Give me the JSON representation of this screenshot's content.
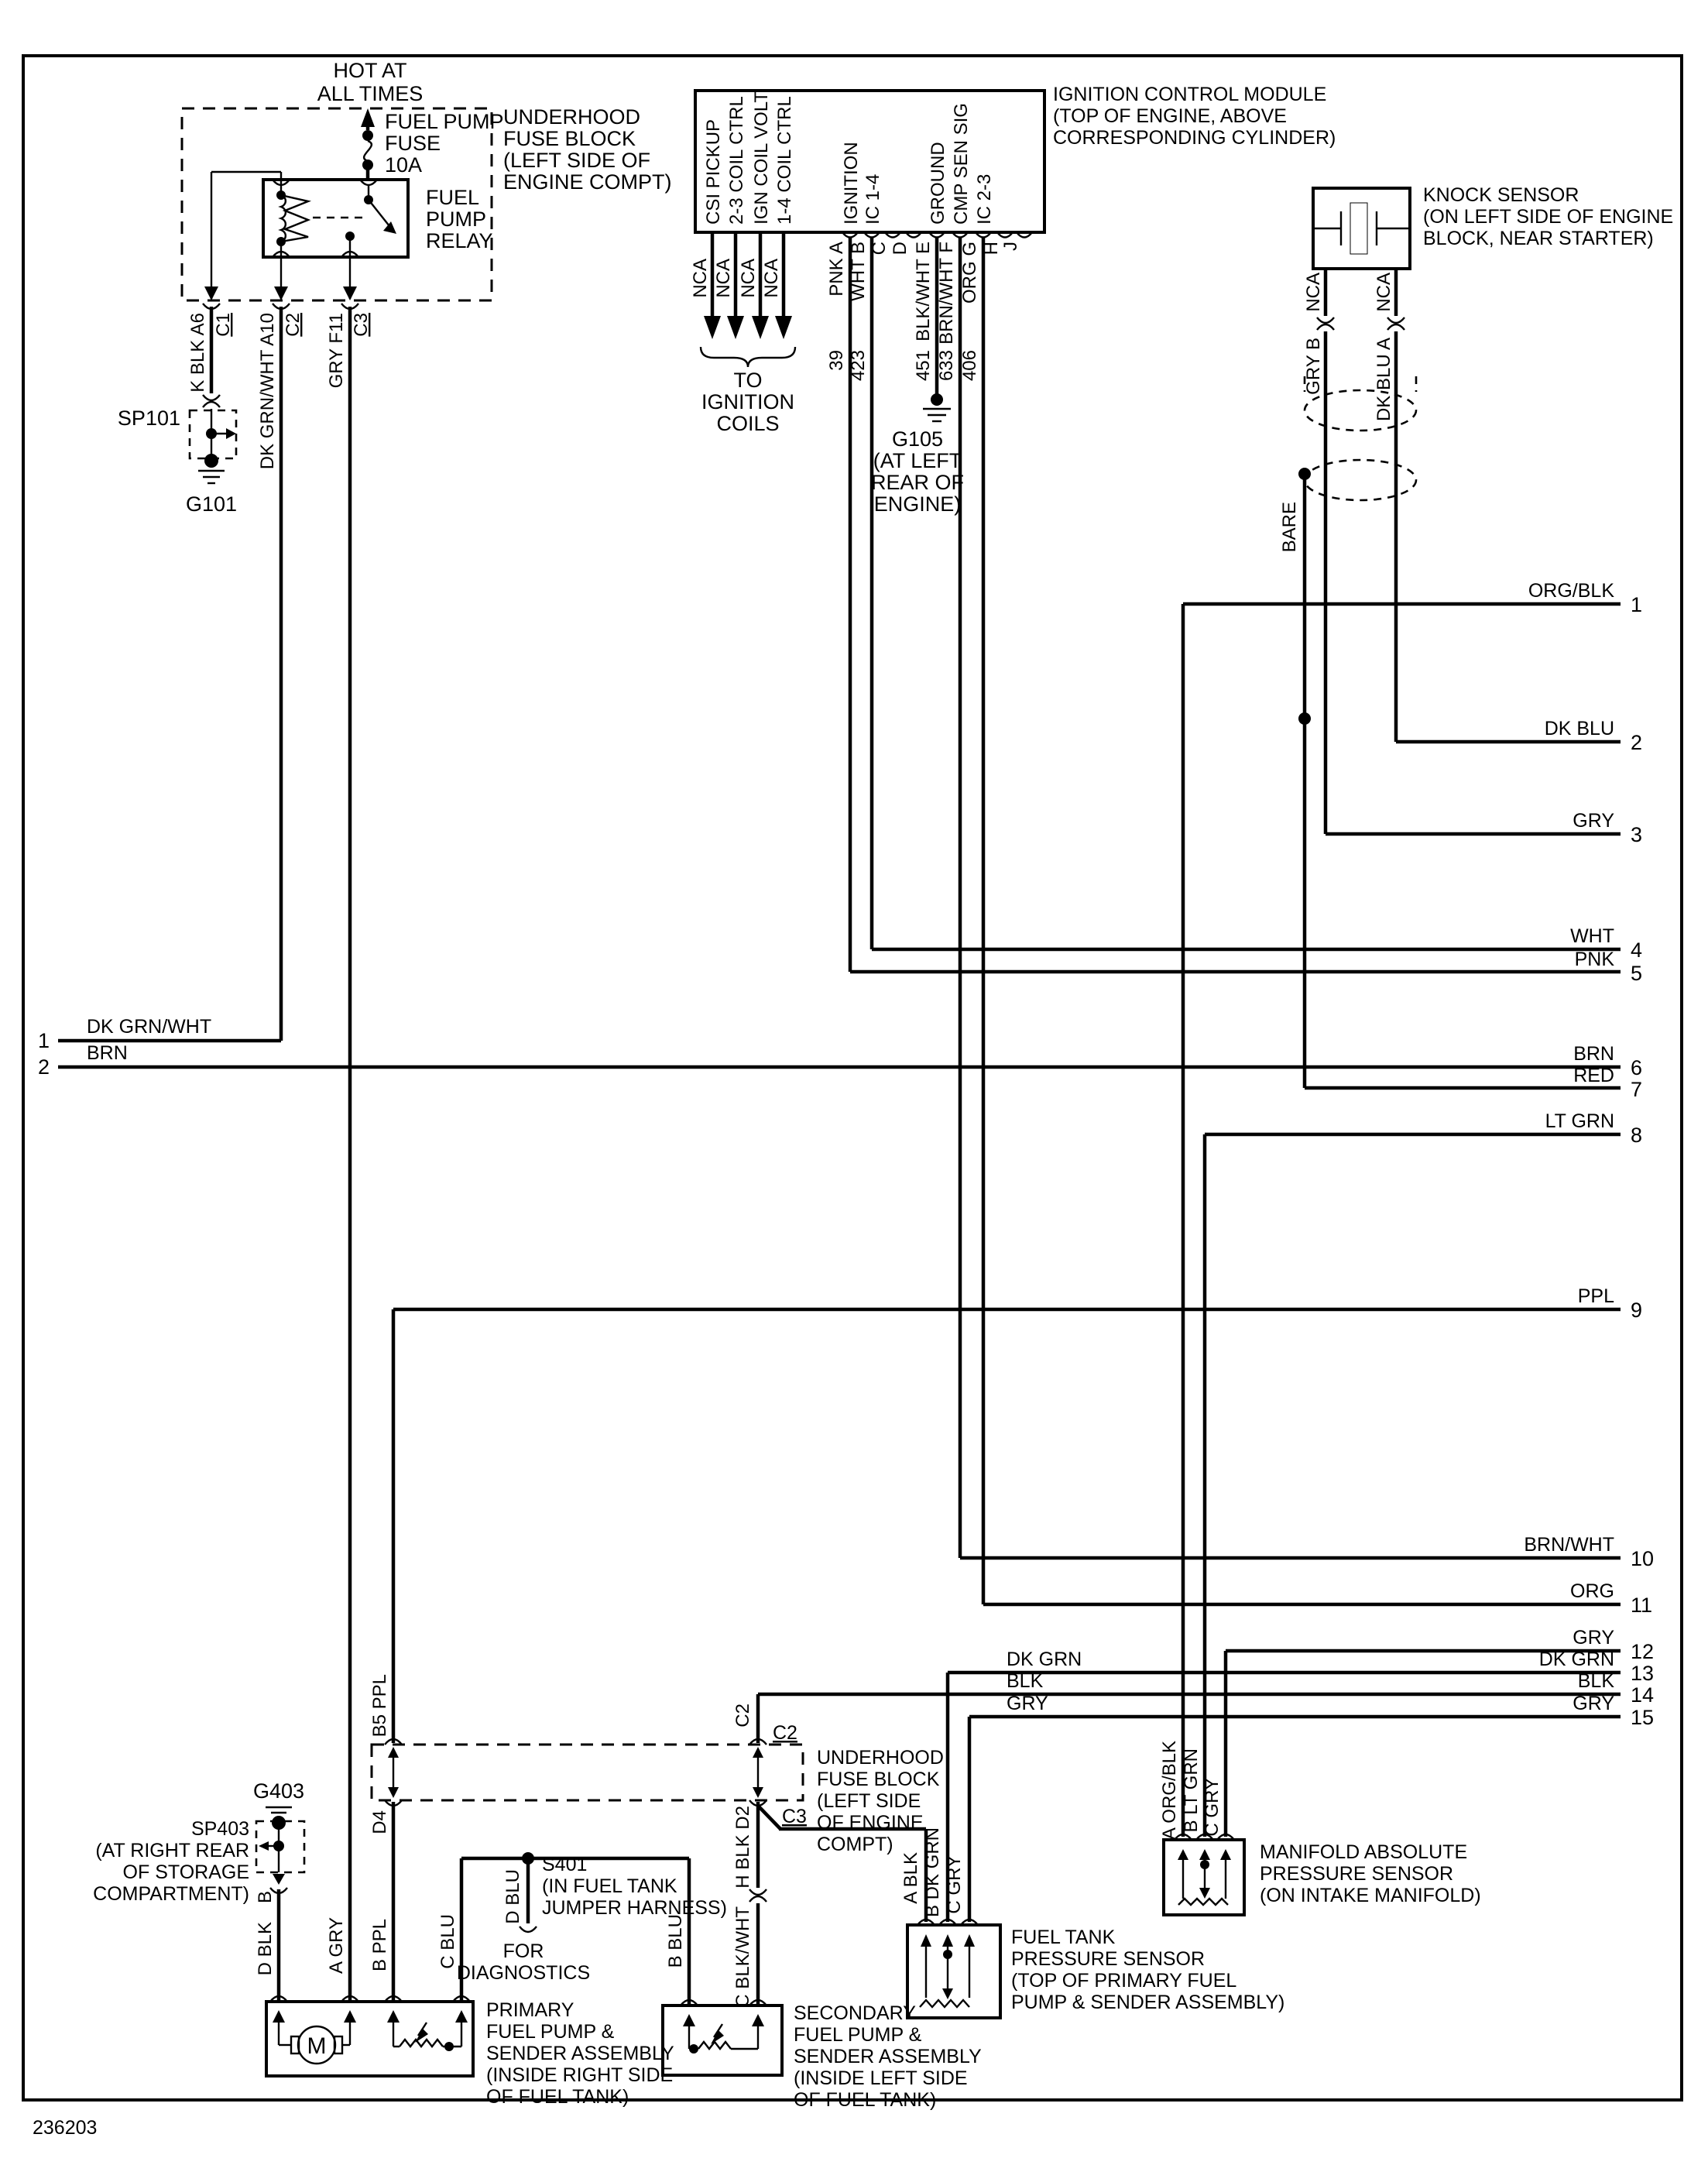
{
  "doc_number": "236203",
  "colors": {
    "ink": "#000000",
    "paper": "#ffffff"
  },
  "power": {
    "hot": [
      "HOT AT",
      "ALL TIMES"
    ],
    "fuse": [
      "FUEL PUMP",
      "FUSE",
      "10A"
    ],
    "relay": [
      "FUEL",
      "PUMP",
      "RELAY"
    ],
    "block": [
      "UNDERHOOD",
      "FUSE BLOCK",
      "(LEFT SIDE OF",
      "ENGINE COMPT)"
    ],
    "drops": [
      {
        "wire": "K BLK A6",
        "conn": "C1"
      },
      {
        "wire": "DK GRN/WHT A10",
        "conn": "C2"
      },
      {
        "wire": "GRY F11",
        "conn": "C3"
      }
    ],
    "splice": "SP101",
    "ground": "G101"
  },
  "left_exits": [
    {
      "num": "1",
      "label": "DK GRN/WHT"
    },
    {
      "num": "2",
      "label": "BRN"
    }
  ],
  "icm": {
    "title": [
      "IGNITION CONTROL MODULE",
      "(TOP OF ENGINE, ABOVE",
      "CORRESPONDING CYLINDER)"
    ],
    "functions": [
      "CSI PICKUP",
      "2-3 COIL CTRL",
      "IGN COIL VOLT",
      "1-4 COIL CTRL",
      "IGNITION",
      "IC 1-4",
      "GROUND",
      "CMP SEN SIG",
      "IC 2-3"
    ],
    "nca": "NCA",
    "to_coils": [
      "TO",
      "IGNITION",
      "COILS"
    ],
    "pins": [
      "PNK A",
      "WHT B",
      "C",
      "D",
      "BLK/WHT E",
      "BRN/WHT F",
      "ORG G",
      "H",
      "J"
    ],
    "circuits": [
      "39",
      "423",
      "451",
      "633",
      "406"
    ],
    "g105": [
      "G105",
      "(AT LEFT",
      "REAR OF",
      "ENGINE)"
    ]
  },
  "knock": {
    "title": [
      "KNOCK SENSOR",
      "(ON LEFT SIDE OF ENGINE",
      "BLOCK, NEAR STARTER)"
    ],
    "nca": "NCA",
    "wire_b": "GRY B",
    "wire_a": "DK BLU A",
    "bare": "BARE"
  },
  "right_exits": [
    {
      "num": "1",
      "label": "ORG/BLK"
    },
    {
      "num": "2",
      "label": "DK BLU"
    },
    {
      "num": "3",
      "label": "GRY"
    },
    {
      "num": "4",
      "label": "WHT"
    },
    {
      "num": "5",
      "label": "PNK"
    },
    {
      "num": "6",
      "label": "BRN"
    },
    {
      "num": "7",
      "label": "RED"
    },
    {
      "num": "8",
      "label": "LT GRN"
    },
    {
      "num": "9",
      "label": "PPL"
    },
    {
      "num": "10",
      "label": "BRN/WHT"
    },
    {
      "num": "11",
      "label": "ORG"
    },
    {
      "num": "12",
      "label": "GRY"
    },
    {
      "num": "13",
      "label": "DK GRN",
      "left_label": "DK GRN"
    },
    {
      "num": "14",
      "label": "BLK",
      "left_label": "BLK"
    },
    {
      "num": "15",
      "label": "GRY",
      "left_label": "GRY"
    }
  ],
  "bottom": {
    "block": [
      "UNDERHOOD",
      "FUSE BLOCK",
      "(LEFT SIDE",
      "OF ENGINE",
      "COMPT)"
    ],
    "conn_c2": "C2",
    "conn_c3": "C3",
    "pin_c2": "C2",
    "ppl_in": "B5 PPL",
    "ppl_out": "D4",
    "ppl_pump": "B PPL",
    "blk_out": "H BLK D2",
    "blkwht": "C BLK/WHT",
    "s401": [
      "S401",
      "(IN FUEL TANK",
      "JUMPER HARNESS)"
    ],
    "diag_drop": "D BLU",
    "diag": [
      "FOR",
      "DIAGNOSTICS"
    ],
    "sp403": [
      "SP403",
      "(AT RIGHT REAR",
      "OF STORAGE",
      "COMPARTMENT)"
    ],
    "g403": "G403",
    "sp403_pin": "B",
    "blk_pump": "D BLK",
    "gry_pump": "A GRY",
    "blu_pump": "C BLU",
    "blu_sec": "B BLU",
    "primary": [
      "PRIMARY",
      "FUEL PUMP &",
      "SENDER ASSEMBLY",
      "(INSIDE RIGHT SIDE",
      "OF FUEL TANK)"
    ],
    "secondary": [
      "SECONDARY",
      "FUEL PUMP &",
      "SENDER ASSEMBLY",
      "(INSIDE LEFT SIDE",
      "OF FUEL TANK)"
    ],
    "motor": "M",
    "ftp_a": "A BLK",
    "ftp_b": "B DK GRN",
    "ftp_c": "C GRY",
    "ftp": [
      "FUEL TANK",
      "PRESSURE SENSOR",
      "(TOP OF PRIMARY FUEL",
      "PUMP & SENDER ASSEMBLY)"
    ],
    "map_a": "A ORG/BLK",
    "map_b": "B LT GRN",
    "map_c": "C GRY",
    "map": [
      "MANIFOLD ABSOLUTE",
      "PRESSURE SENSOR",
      "(ON INTAKE MANIFOLD)"
    ]
  }
}
